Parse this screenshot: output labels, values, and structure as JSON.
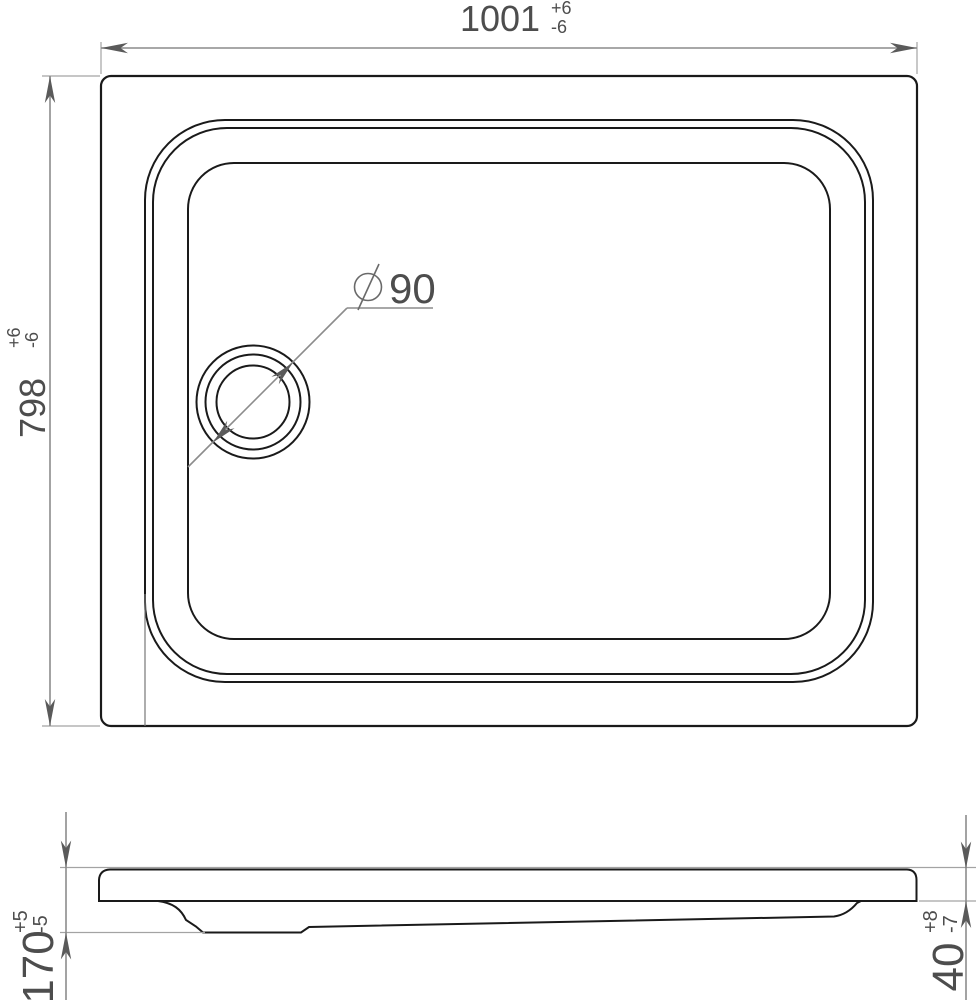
{
  "colors": {
    "outline": "#1a1a1a",
    "dimension_line": "#8c8c8c",
    "extension_line": "#a3a3a3",
    "arrow": "#5a5a5a",
    "text": "#4d4d4d",
    "background": "#ffffff"
  },
  "dimensions": {
    "width": {
      "value": "1001",
      "tol_plus": "+6",
      "tol_minus": "-6"
    },
    "depth": {
      "value": "798",
      "tol_plus": "+6",
      "tol_minus": "-6"
    },
    "drain": {
      "symbol": "⌀",
      "value": "90"
    },
    "height": {
      "value": "170",
      "tol_plus": "+5",
      "tol_minus": "-5"
    },
    "rim": {
      "value": "40",
      "tol_plus": "+8",
      "tol_minus": "-7"
    }
  }
}
